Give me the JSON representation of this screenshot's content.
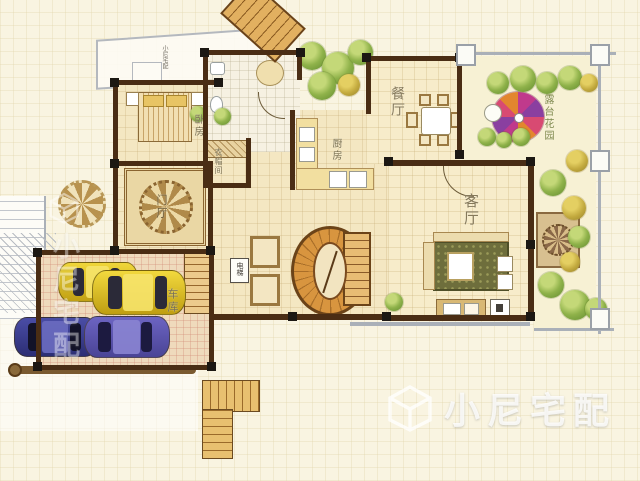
{
  "figure": {
    "type": "residential-floor-plan"
  },
  "labels": {
    "bedroom": "卧房",
    "closet": "衣帽间",
    "foyer": "门厅",
    "kitchen": "厨房",
    "dining": "餐厅",
    "living": "客厅",
    "garage": "车库",
    "terrace_garden": "露台花园",
    "elevator": "电梯",
    "tiny_annotation": "小尼宅配"
  },
  "watermark": {
    "brand": "小尼宅配",
    "logo": "cube-logo",
    "side_brand": "小尼宅配"
  },
  "cars": [
    {
      "name": "yellow-car-back",
      "hex": "#e3c21d"
    },
    {
      "name": "yellow-car-front",
      "hex": "#e8c92a"
    },
    {
      "name": "dark-blue-car",
      "hex": "#3c3f92"
    },
    {
      "name": "purple-car",
      "hex": "#5c55b2"
    }
  ],
  "colors": {
    "background": "#f9f4e1",
    "floor": "#f4e7c2",
    "wall": "#4a2d14",
    "garage_floor": "#efdabc",
    "stair_wood": "#d8953f",
    "umbrella_magenta": "#c03a8c",
    "umbrella_purple": "#8a3fa0",
    "umbrella_orange": "#e2862e",
    "tree_green": "#8fb24a",
    "watermark_white": "rgba(255,255,255,0.82)"
  }
}
